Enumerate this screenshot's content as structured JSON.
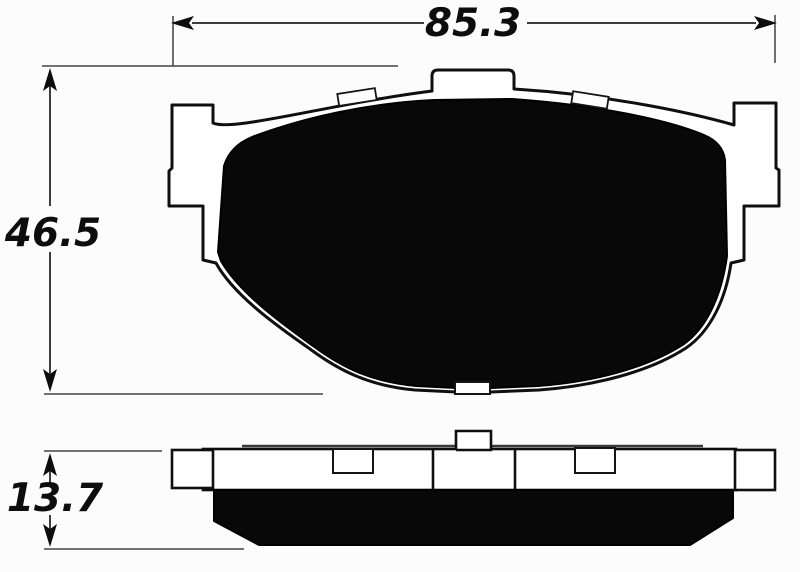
{
  "dimensions": {
    "width": {
      "label": "85.3"
    },
    "height": {
      "label": "46.5"
    },
    "thickness": {
      "label": "13.7"
    }
  },
  "colors": {
    "background": "#fcfcfc",
    "line": "#0f0f0f",
    "pad_fill": "#080808",
    "dimension_line": "#3d3d3d",
    "extension_line": "#5f5f5f",
    "text": "#0d0d0d"
  }
}
